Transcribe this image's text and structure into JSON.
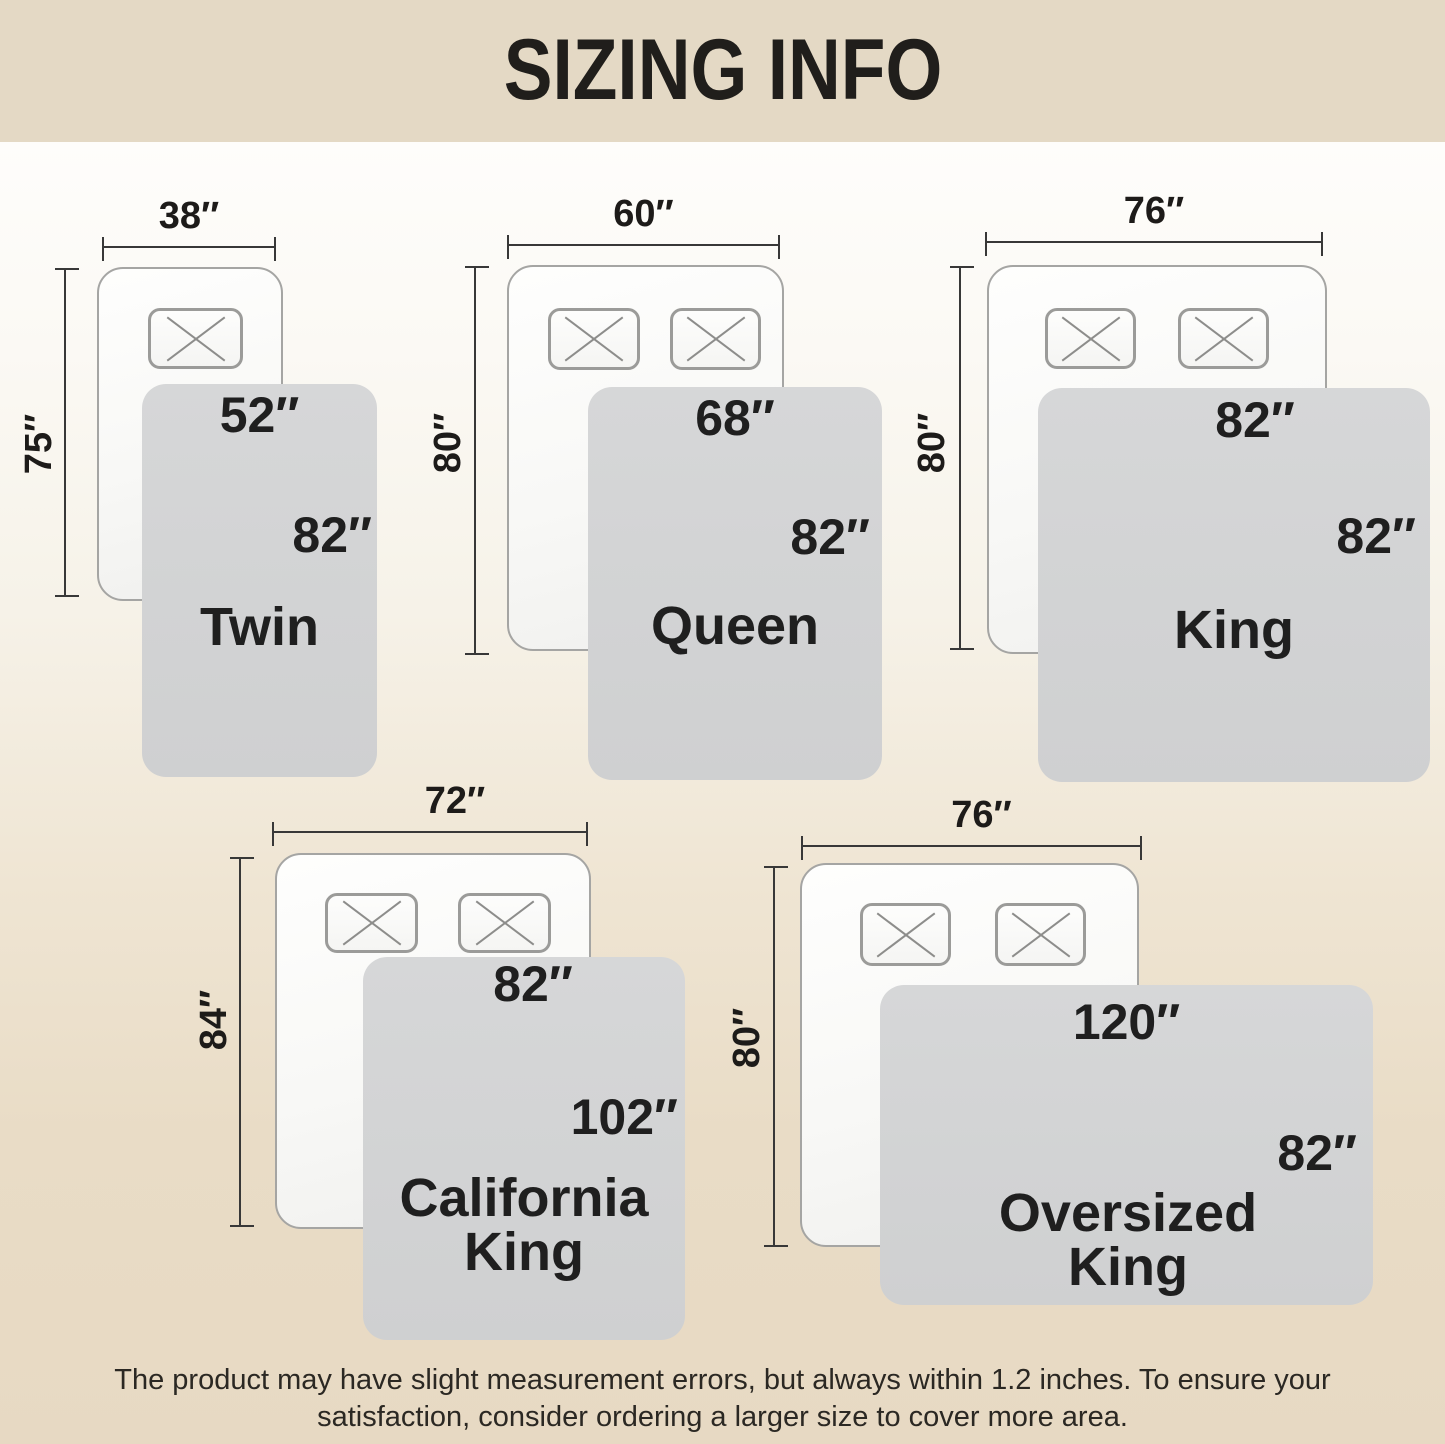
{
  "title": "SIZING INFO",
  "sizes": [
    {
      "name": "Twin",
      "bed_width": "38″",
      "bed_length": "75″",
      "blanket_width": "52″",
      "blanket_length": "82″",
      "pillow_count": 1
    },
    {
      "name": "Queen",
      "bed_width": "60″",
      "bed_length": "80″",
      "blanket_width": "68″",
      "blanket_length": "82″",
      "pillow_count": 2
    },
    {
      "name": "King",
      "bed_width": "76″",
      "bed_length": "80″",
      "blanket_width": "82″",
      "blanket_length": "82″",
      "pillow_count": 2
    },
    {
      "name": "California King",
      "bed_width": "72″",
      "bed_length": "84″",
      "blanket_width": "82″",
      "blanket_length": "102″",
      "pillow_count": 2
    },
    {
      "name": "Oversized King",
      "bed_width": "76″",
      "bed_length": "80″",
      "blanket_width": "120″",
      "blanket_length": "82″",
      "pillow_count": 2
    }
  ],
  "footer": {
    "line1": "The product may have slight measurement errors, but always within 1.2 inches. To ensure your",
    "line2": "satisfaction, consider ordering a larger size to cover more area."
  },
  "colors": {
    "header_bg": "#e4d9c5",
    "background_top": "#fefdfb",
    "background_bottom": "#e7d9c3",
    "mattress_fill": "#f9f9f7",
    "mattress_border": "#a5a5a3",
    "blanket_fill": "#d3d4d5",
    "dimension_line": "#383838",
    "text": "#1f1f1f"
  }
}
